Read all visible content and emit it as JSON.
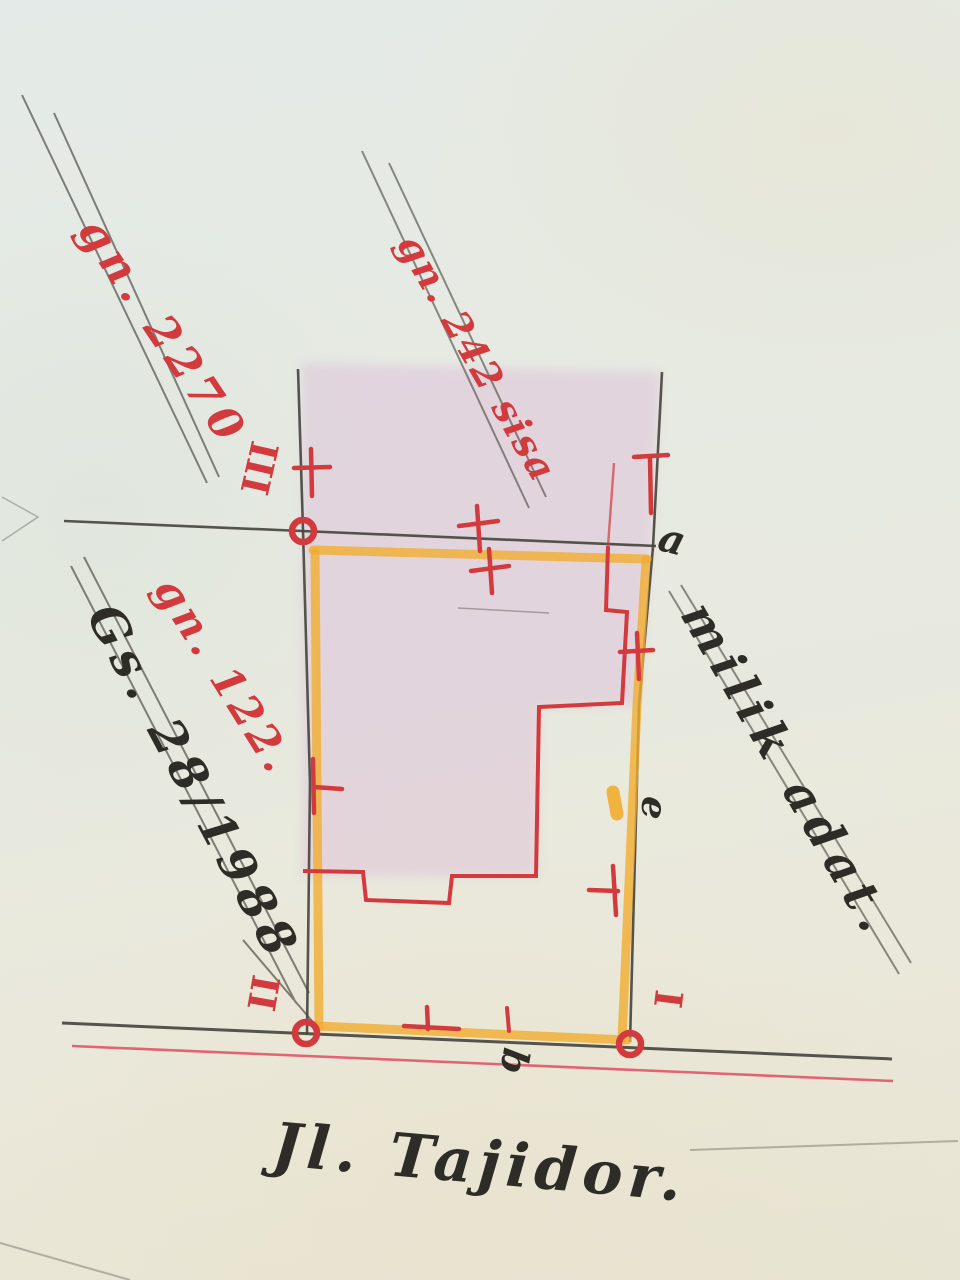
{
  "map": {
    "plot_labels": {
      "left_parcel": "gn. 2270",
      "top_parcel": "gn. 242 sisa",
      "main_parcel": "gn. 122.",
      "survey_number": "Gs. 28/1988",
      "ownership_note": "milik adat.",
      "street_name": "Jl. Tajidor."
    },
    "point_labels": {
      "a": "a",
      "e": "e",
      "b": "b"
    },
    "corner_numerals": {
      "one": "I",
      "two": "II",
      "three": "III"
    }
  },
  "colors": {
    "red_ink": "#d23a3e",
    "red_line": "#e0556a",
    "orange_marker": "#f1ad2f",
    "pencil": "#45443c",
    "black_ink": "#2e2c27",
    "pink_wash": "#dcb8d8",
    "paper": "#e9ebe1"
  }
}
